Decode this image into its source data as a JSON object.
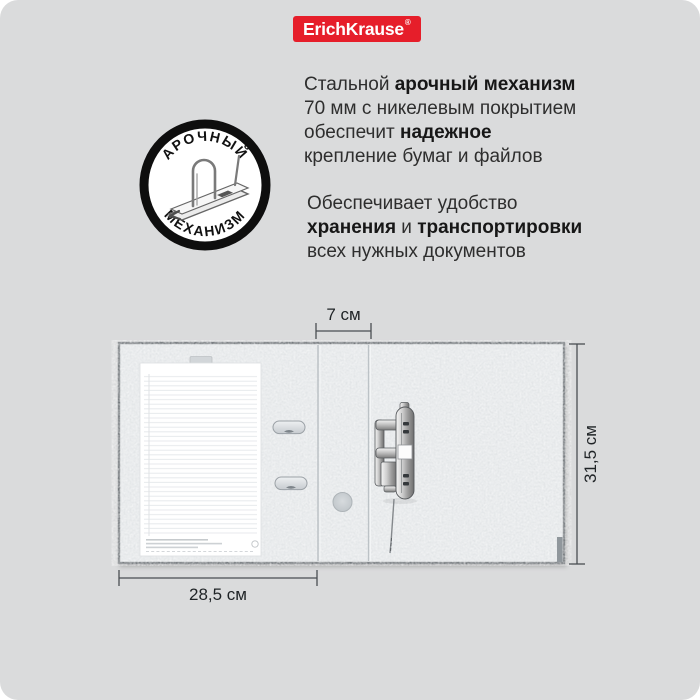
{
  "brand": {
    "logo_text": "ErichKrause",
    "reg_mark": "®",
    "logo_bg": "#e61e2a"
  },
  "intro": {
    "line1_normal": "Стальной ",
    "line1_bold": "арочный механизм",
    "line2": "70 мм с никелевым покрытием",
    "line3_normal": "обеспечит ",
    "line3_bold": "надежное",
    "line4": "крепление бумаг и файлов"
  },
  "benefit": {
    "line1": "Обеспечивает удобство",
    "line2_bold1": "хранения",
    "line2_normal": " и ",
    "line2_bold2": "транспортировки",
    "line3": "всех нужных документов"
  },
  "badge": {
    "arc_top": "АРОЧНЫЙ",
    "arc_bottom": "МЕХАНИЗМ"
  },
  "dimensions": {
    "spine_width": "7 см",
    "height": "31,5 см",
    "cover_width": "28,5 см"
  },
  "colors": {
    "background": "#dadbdc",
    "folder_face": "#e2e5e7",
    "folder_edge": "#73787c",
    "dimension_line": "#494e53",
    "text": "#2e2e2e"
  }
}
